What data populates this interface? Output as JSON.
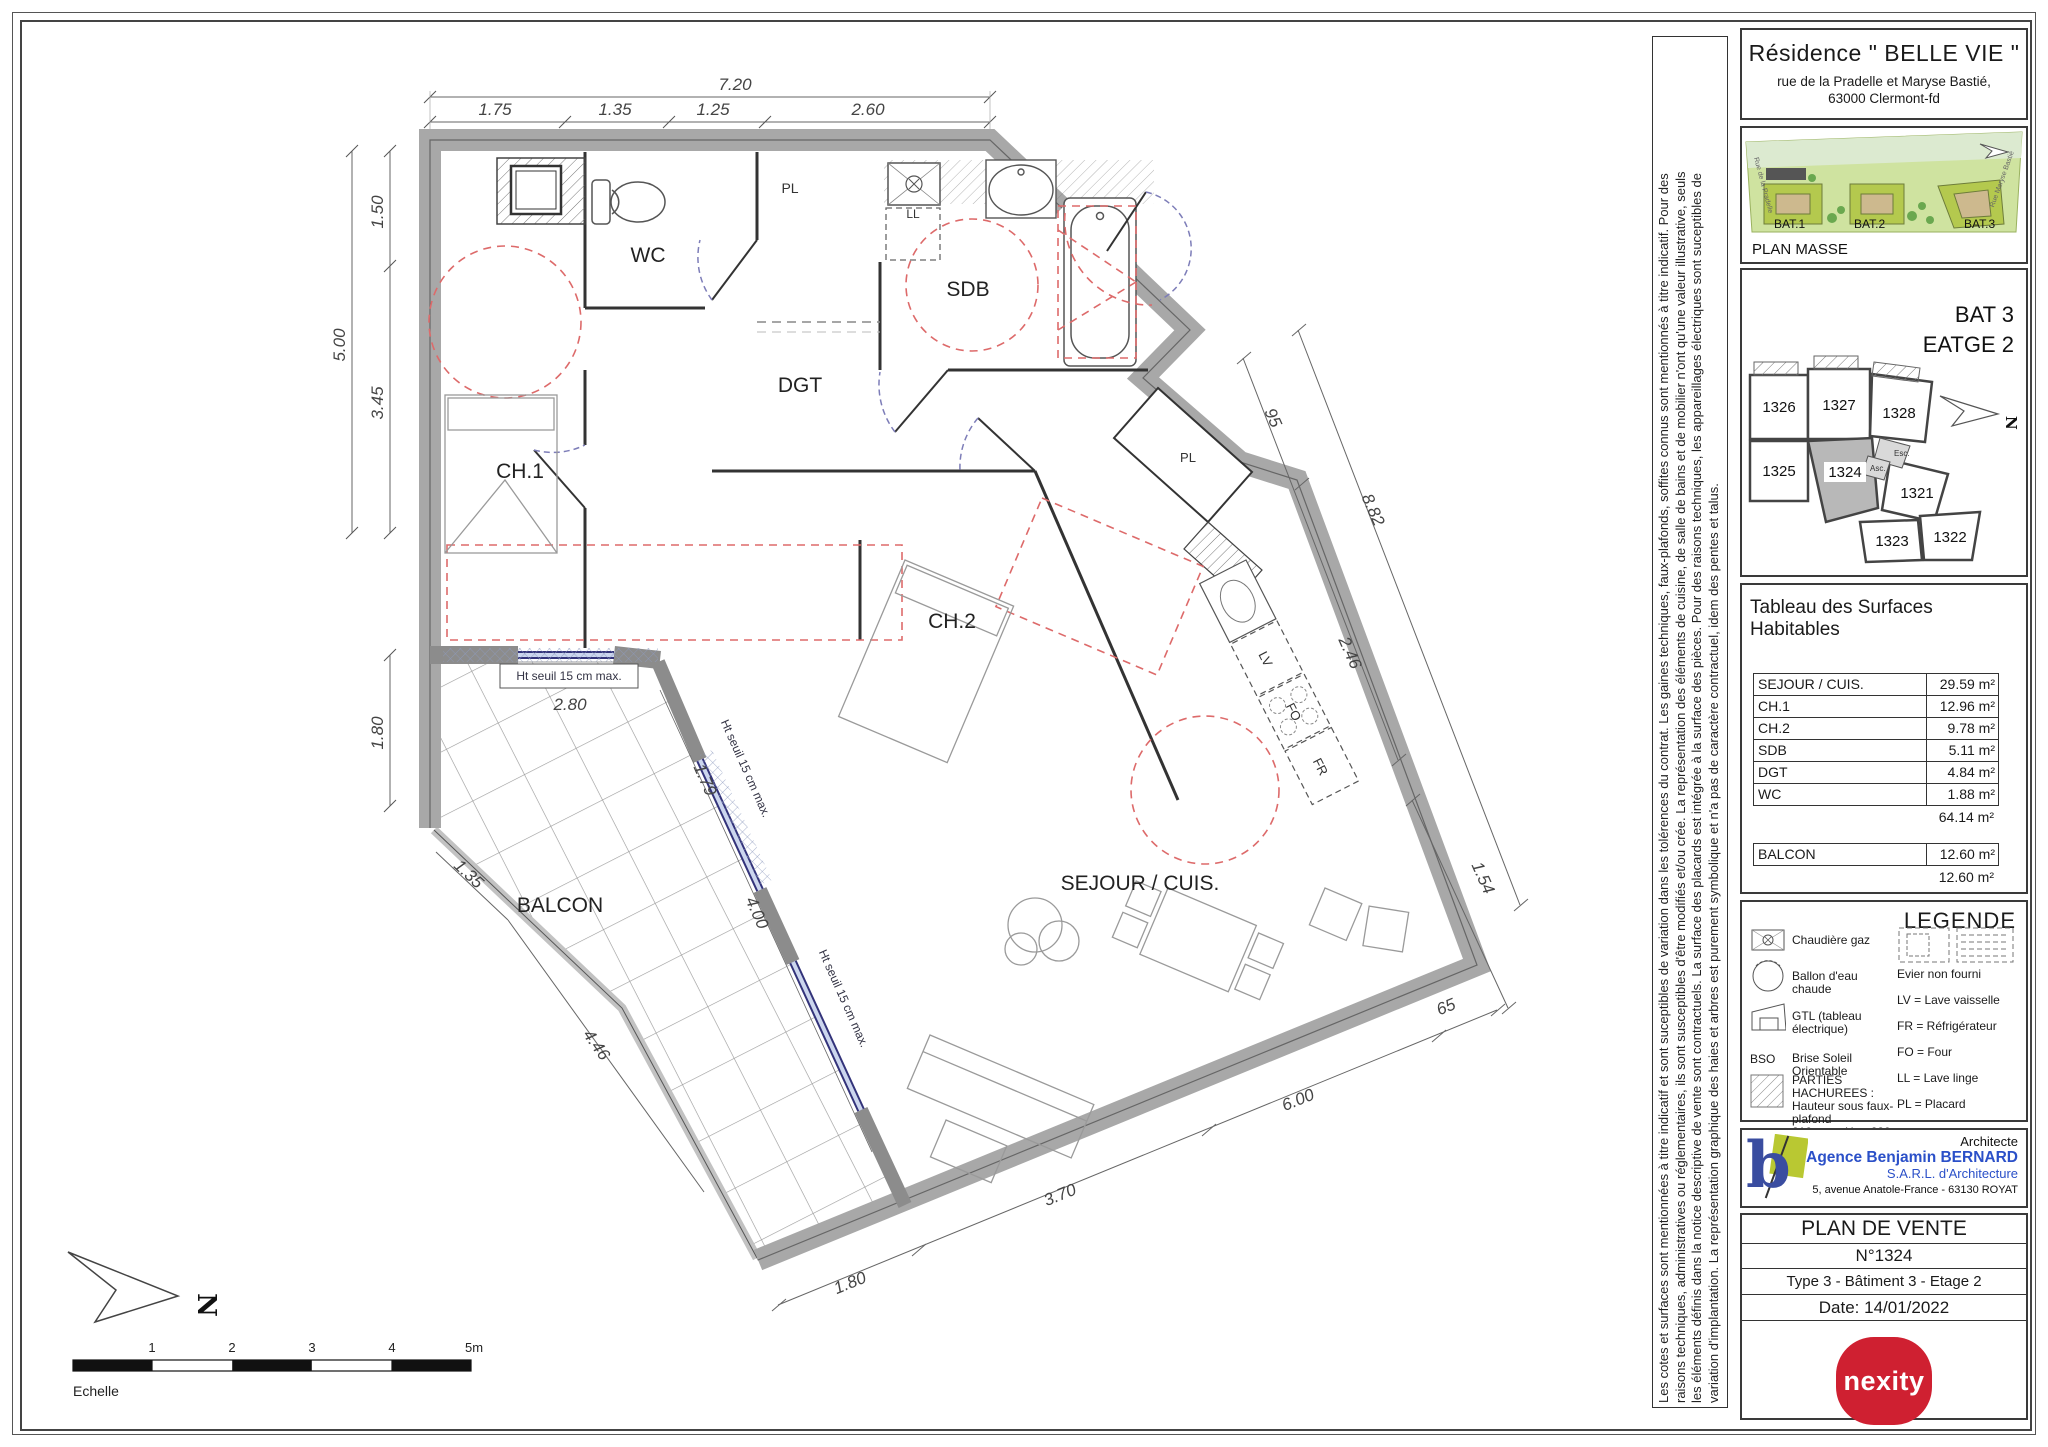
{
  "titleblock": {
    "residence": "Résidence \" BELLE VIE \"",
    "address1": "rue de la Pradelle et Maryse Bastié,",
    "address2": "63000 Clermont-fd"
  },
  "plan_masse": {
    "label": "PLAN MASSE",
    "buildings": [
      "BAT.1",
      "BAT.2",
      "BAT.3"
    ],
    "street_left": "Rue de la Pradelle",
    "street_right": "Rue Maryse Bastié"
  },
  "key_plan": {
    "building": "BAT 3",
    "floor": "EATGE 2",
    "north": "N",
    "stair": "Esc.",
    "elevator": "Asc.",
    "units": [
      "1326",
      "1327",
      "1328",
      "1325",
      "1324",
      "1321",
      "1323",
      "1322"
    ]
  },
  "surfaces": {
    "title": "Tableau des Surfaces Habitables",
    "rows": [
      {
        "label": "SEJOUR / CUIS.",
        "area": "29.59 m²"
      },
      {
        "label": "CH.1",
        "area": "12.96 m²"
      },
      {
        "label": "CH.2",
        "area": "9.78 m²"
      },
      {
        "label": "SDB",
        "area": "5.11 m²"
      },
      {
        "label": "DGT",
        "area": "4.84 m²"
      },
      {
        "label": "WC",
        "area": "1.88 m²"
      }
    ],
    "total": "64.14 m²",
    "balcony": {
      "label": "BALCON",
      "area": "12.60 m²"
    },
    "balcony_total": "12.60 m²"
  },
  "legende": {
    "title": "LEGENDE",
    "chaudiere": "Chaudière gaz",
    "ballon": "Ballon d'eau chaude",
    "gtl": "GTL (tableau électrique)",
    "bso_code": "BSO",
    "bso": "Brise Soleil Orientable",
    "hachures1": "PARTIES HACHUREES :",
    "hachures2": "Hauteur sous faux-plafond",
    "hachures3": "210 cm < Ht < 230 cm",
    "evier": "Evier non fourni",
    "lv": "LV = Lave vaisselle",
    "fr": "FR = Réfrigérateur",
    "fo": "FO = Four",
    "ll": "LL = Lave linge",
    "pl": "PL = Placard"
  },
  "architect": {
    "role": "Architecte",
    "agency": "Agence Benjamin BERNARD",
    "company": "S.A.R.L. d'Architecture",
    "address": "5, avenue Anatole-France - 63130 ROYAT"
  },
  "sale": {
    "title": "PLAN DE VENTE",
    "number": "N°1324",
    "type": "Type 3 - Bâtiment 3 - Etage 2",
    "date": "Date: 14/01/2022",
    "brand": "nexity"
  },
  "disclaimer": {
    "line1": "Les cotes et surfaces sont mentionnées à titre indicatif et sont suceptibles de variation dans les tolérences du contrat. Les gaines techniques, faux-plafonds, soffites connus sont mentionnés à titre indicatif. Pour des",
    "line2": "raisons techniques, administratives ou réglementaires, ils sont susceptibles d'être modifiés et/ou crée. La représentation des éléments de cuisine, de salle de bains et de mobilier n'ont qu'une valeur illustrative, seuls",
    "line3": "les éléments définis dans la notice descriptive de vente sont contractuels. La surface des placards est intégrée à la surface des pièces. Pour des raisons techniques, les appareillages électriques sont suceptibles de",
    "line4": "variation d'implantation. La représentation graphique des haies et arbres est purement symbolique et n'a pas de caractère contractuel, idem des pentes et talus."
  },
  "plan": {
    "rooms": {
      "wc": "WC",
      "sdb": "SDB",
      "dgt": "DGT",
      "ch1": "CH.1",
      "ch2": "CH.2",
      "sejour": "SEJOUR / CUIS.",
      "balcon": "BALCON",
      "pl_top": "PL",
      "pl_kitchen": "PL",
      "ll": "LL",
      "lv": "LV",
      "fo": "FO",
      "fr": "FR"
    },
    "seuil": "Ht seuil 15 cm max.",
    "north": "N",
    "scale_label": "Echelle",
    "scale_ticks": [
      "1",
      "2",
      "3",
      "4",
      "5m"
    ],
    "dims": {
      "top_total": "7.20",
      "t1": "1.75",
      "t2": "1.35",
      "t3": "1.25",
      "t4": "2.60",
      "l_total": "5.00",
      "l1": "1.50",
      "l2": "3.45",
      "l3": "1.80",
      "r1": "95",
      "r_total": "8.82",
      "r2": "2.46",
      "r3": "1.54",
      "r4": "65",
      "b1": "1.80",
      "b2": "3.70",
      "b3": "6.00",
      "bal1": "1.35",
      "bal2": "4.46",
      "bal3": "4.00",
      "bal4": "2.80",
      "bal5": "1.79"
    }
  }
}
